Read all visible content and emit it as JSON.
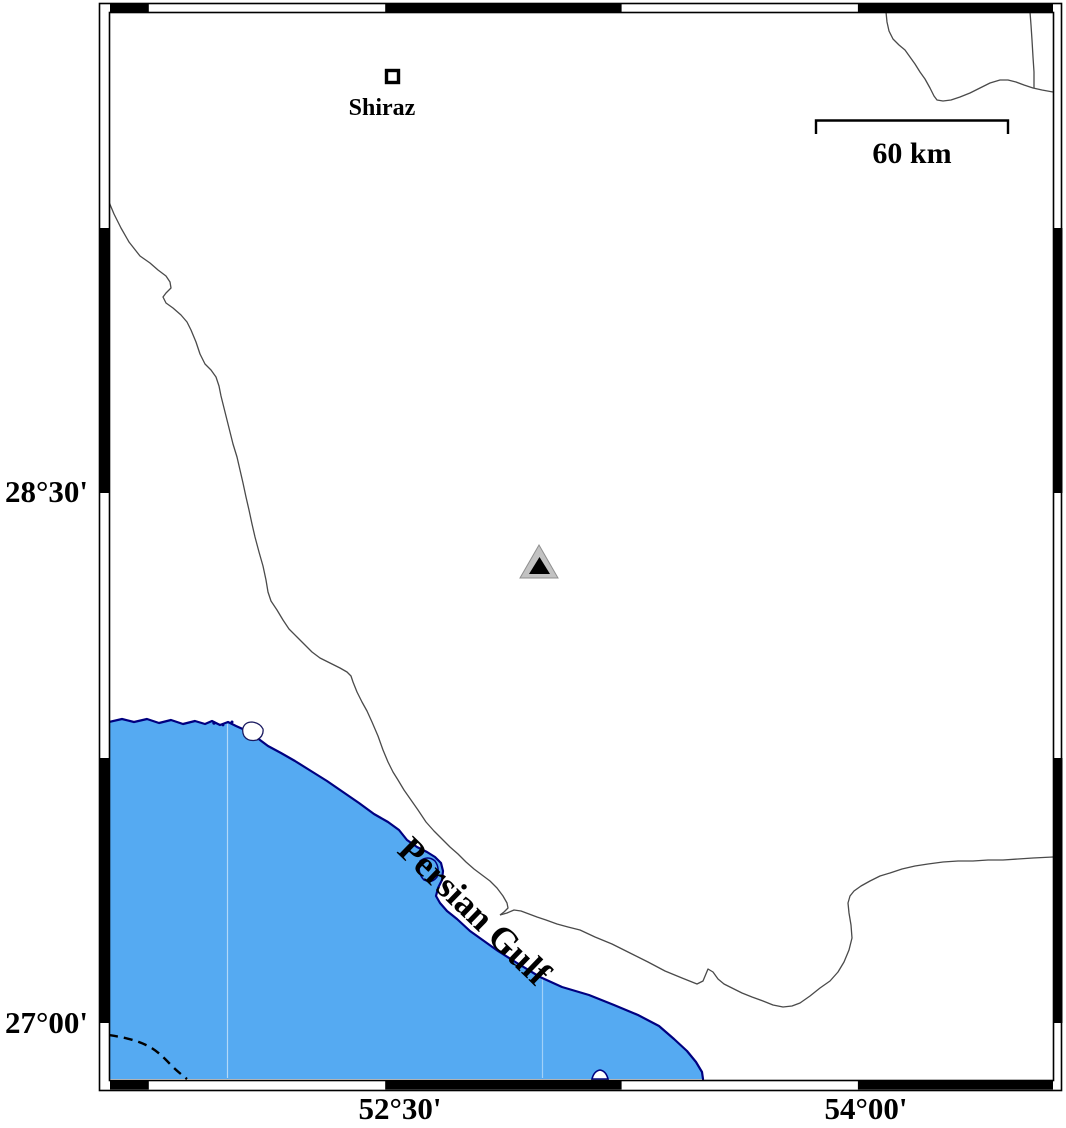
{
  "map": {
    "region": {
      "graticule": {
        "lat": [
          {
            "label": "28°30'"
          },
          {
            "label": "27°00'"
          }
        ],
        "lon": [
          {
            "label": "52°30'"
          },
          {
            "label": "54°00'"
          }
        ]
      }
    },
    "city": {
      "name": "Shiraz",
      "marker": "open-square"
    },
    "sea": {
      "name": "Persian Gulf"
    },
    "station": {
      "marker": "triangle",
      "fill": "gray-with-black-core"
    },
    "scalebar": {
      "label": "60 km"
    },
    "colors": {
      "water": "#55aaf2",
      "coastline": "#000080",
      "political_boundary": "#4a4a4a",
      "frame": "#000000",
      "land": "#ffffff",
      "station_outer": "#c2c2c2",
      "station_inner": "#000000"
    }
  }
}
